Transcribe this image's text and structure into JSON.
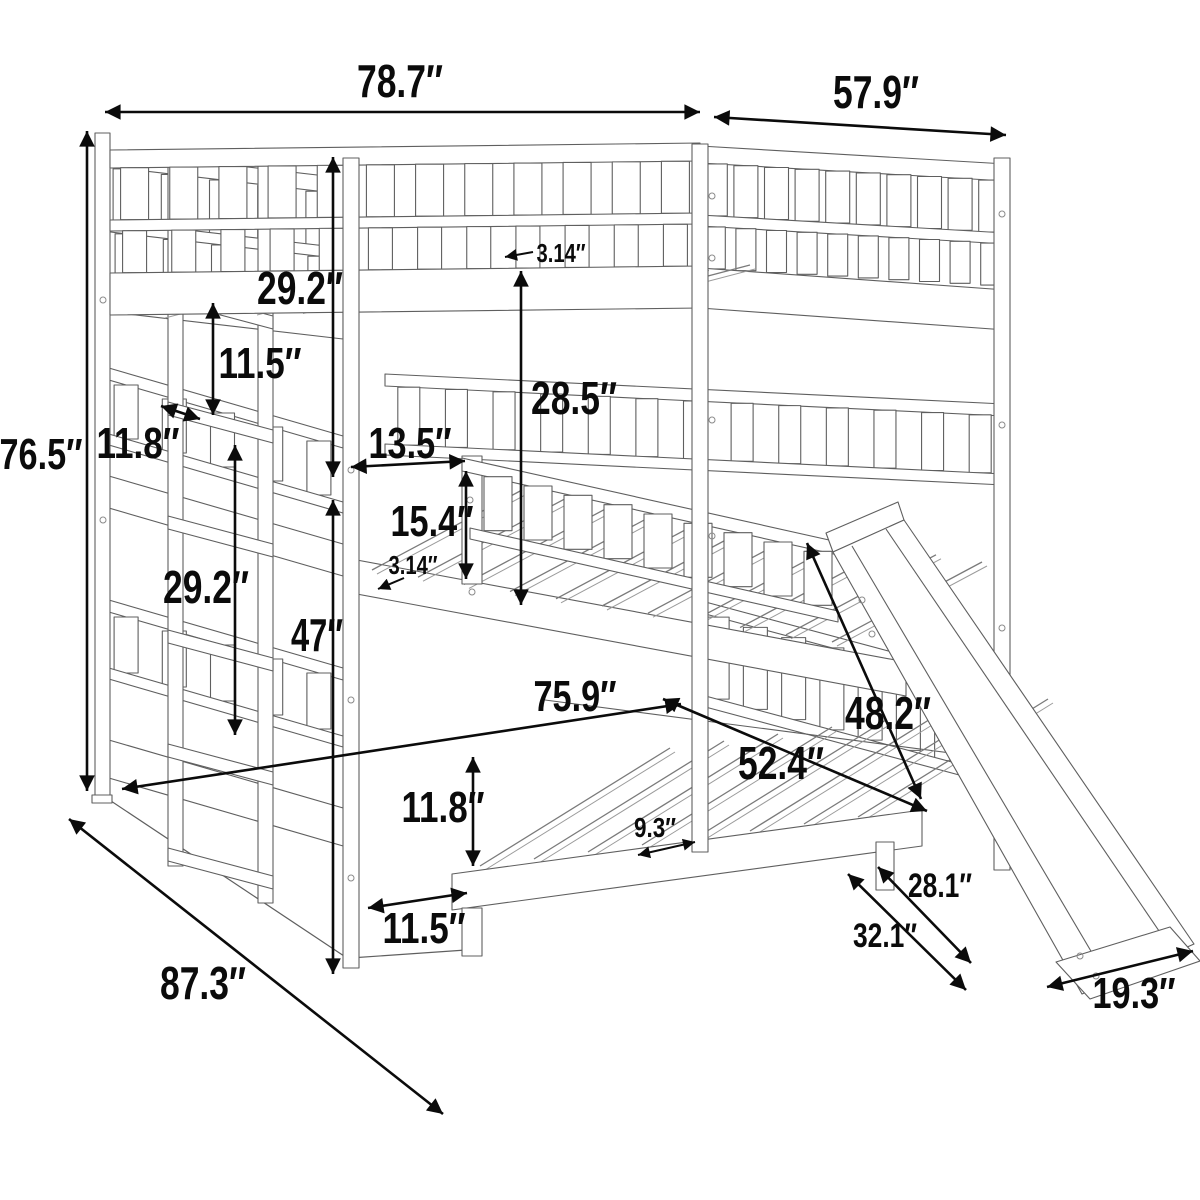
{
  "diagram": {
    "subject": "triple bunk bed with ladder and slide",
    "view": "perspective line drawing",
    "unit_mark": "″"
  },
  "style": {
    "background": "#ffffff",
    "line_color": "#5f5f5f",
    "hatch_color": "#7a7a7a",
    "dimension_color": "#0b0b0b"
  },
  "dimensions": [
    {
      "id": "bed-length-top",
      "label": "78.7″",
      "x1": 105,
      "y1": 112,
      "x2": 700,
      "y2": 112,
      "heads": "both",
      "lx": 400,
      "ly": 97,
      "fs": 46,
      "anchor": "middle"
    },
    {
      "id": "bed-width-top",
      "label": "57.9″",
      "x1": 714,
      "y1": 117,
      "x2": 1006,
      "y2": 135,
      "heads": "both",
      "lx": 876,
      "ly": 108,
      "fs": 46,
      "anchor": "middle"
    },
    {
      "id": "bed-height",
      "label": "76.5″",
      "x1": 87,
      "y1": 131,
      "x2": 87,
      "y2": 791,
      "heads": "both",
      "lx": 41,
      "ly": 469,
      "fs": 44,
      "anchor": "middle"
    },
    {
      "id": "top-rail-height",
      "label": "29.2″",
      "x1": 333,
      "y1": 157,
      "x2": 333,
      "y2": 477,
      "heads": "both",
      "lx": 300,
      "ly": 304,
      "fs": 46,
      "anchor": "middle"
    },
    {
      "id": "ladder-step-spacing",
      "label": "11.5″",
      "x1": 213,
      "y1": 303,
      "x2": 213,
      "y2": 415,
      "heads": "both",
      "lx": 260,
      "ly": 378,
      "fs": 44,
      "anchor": "middle"
    },
    {
      "id": "ladder-step-depth",
      "label": "11.8″",
      "x1": 161,
      "y1": 406,
      "x2": 200,
      "y2": 419,
      "heads": "both",
      "lx": 138,
      "ly": 458,
      "fs": 44,
      "anchor": "middle"
    },
    {
      "id": "guard-gap-width",
      "label": "13.5″",
      "x1": 351,
      "y1": 467,
      "x2": 465,
      "y2": 461,
      "heads": "both",
      "lx": 410,
      "ly": 458,
      "fs": 44,
      "anchor": "middle"
    },
    {
      "id": "guard-rail-height",
      "label": "15.4″",
      "x1": 466,
      "y1": 471,
      "x2": 466,
      "y2": 579,
      "heads": "both",
      "lx": 432,
      "ly": 536,
      "fs": 44,
      "anchor": "middle"
    },
    {
      "id": "slat-thickness-top",
      "label": "3.14″",
      "x1": 533,
      "y1": 252,
      "x2": 505,
      "y2": 257,
      "heads": "end",
      "lx": 561,
      "ly": 262,
      "fs": 26,
      "anchor": "middle"
    },
    {
      "id": "bunk-clearance",
      "label": "28.5″",
      "x1": 521,
      "y1": 271,
      "x2": 521,
      "y2": 605,
      "heads": "both",
      "lx": 531,
      "ly": 414,
      "fs": 46,
      "anchor": "start"
    },
    {
      "id": "slat-thickness-middle",
      "label": "3.14″",
      "x1": 404,
      "y1": 578,
      "x2": 378,
      "y2": 589,
      "heads": "end",
      "lx": 413,
      "ly": 574,
      "fs": 26,
      "anchor": "middle"
    },
    {
      "id": "middle-rail-height",
      "label": "29.2″",
      "x1": 235,
      "y1": 445,
      "x2": 235,
      "y2": 735,
      "heads": "both",
      "lx": 206,
      "ly": 603,
      "fs": 46,
      "anchor": "middle"
    },
    {
      "id": "middle-bunk-height",
      "label": "47″",
      "x1": 333,
      "y1": 500,
      "x2": 333,
      "y2": 974,
      "heads": "both",
      "lx": 317,
      "ly": 651,
      "fs": 46,
      "anchor": "middle"
    },
    {
      "id": "bottom-bunk-length",
      "label": "75.9″",
      "x1": 122,
      "y1": 789,
      "x2": 681,
      "y2": 704,
      "heads": "both",
      "lx": 575,
      "ly": 711,
      "fs": 44,
      "anchor": "middle"
    },
    {
      "id": "bottom-bunk-width",
      "label": "52.4″",
      "x1": 663,
      "y1": 699,
      "x2": 927,
      "y2": 811,
      "heads": "both",
      "lx": 781,
      "ly": 779,
      "fs": 46,
      "anchor": "middle"
    },
    {
      "id": "slide-length",
      "label": "48.2″",
      "x1": 807,
      "y1": 543,
      "x2": 921,
      "y2": 799,
      "heads": "both",
      "lx": 888,
      "ly": 729,
      "fs": 46,
      "anchor": "middle"
    },
    {
      "id": "bottom-rail-height",
      "label": "11.8″",
      "x1": 473,
      "y1": 757,
      "x2": 473,
      "y2": 866,
      "heads": "both",
      "lx": 443,
      "ly": 822,
      "fs": 44,
      "anchor": "middle"
    },
    {
      "id": "slat-spacing",
      "label": "9.3″",
      "x1": 638,
      "y1": 855,
      "x2": 695,
      "y2": 842,
      "heads": "both",
      "lx": 655,
      "ly": 837,
      "fs": 28,
      "anchor": "middle"
    },
    {
      "id": "ladder-width",
      "label": "11.5″",
      "x1": 368,
      "y1": 908,
      "x2": 467,
      "y2": 893,
      "heads": "both",
      "lx": 424,
      "ly": 943,
      "fs": 44,
      "anchor": "middle"
    },
    {
      "id": "total-depth-diagonal",
      "label": "87.3″",
      "x1": 69,
      "y1": 819,
      "x2": 443,
      "y2": 1114,
      "heads": "both",
      "lx": 203,
      "ly": 999,
      "fs": 46,
      "anchor": "middle"
    },
    {
      "id": "slide-foot-offset",
      "label": "28.1″",
      "x1": 878,
      "y1": 867,
      "x2": 971,
      "y2": 963,
      "heads": "both",
      "lx": 940,
      "ly": 897,
      "fs": 34,
      "anchor": "middle"
    },
    {
      "id": "slide-foot-depth",
      "label": "32.1″",
      "x1": 848,
      "y1": 874,
      "x2": 966,
      "y2": 990,
      "heads": "both",
      "lx": 885,
      "ly": 947,
      "fs": 34,
      "anchor": "middle"
    },
    {
      "id": "slide-width",
      "label": "19.3″",
      "x1": 1047,
      "y1": 987,
      "x2": 1193,
      "y2": 951,
      "heads": "both",
      "lx": 1134,
      "ly": 1008,
      "fs": 44,
      "anchor": "middle"
    }
  ]
}
